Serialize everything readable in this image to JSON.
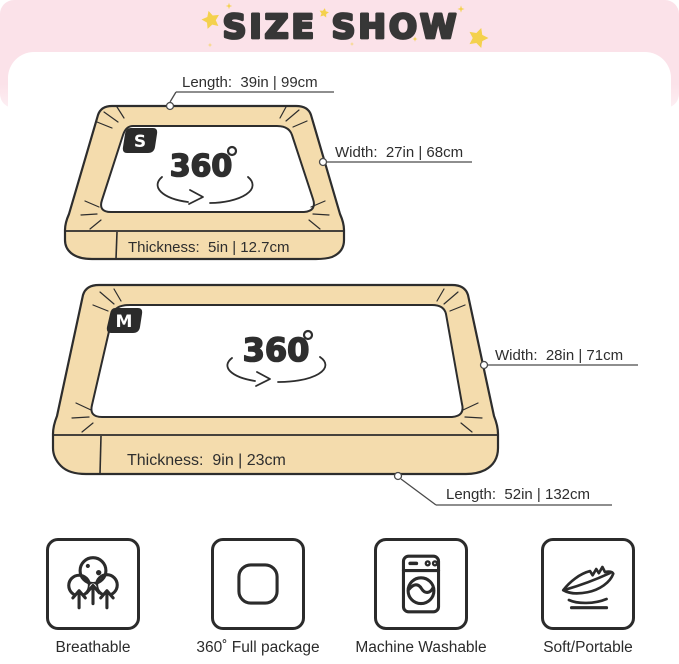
{
  "header": {
    "title": "SIZE SHOW"
  },
  "theme": {
    "pink": "#FBE2E9",
    "star_yellow": "#F4D14D",
    "bed_fill": "#F4DCAD",
    "outline": "#2D2D2D",
    "text": "#2E2E2E"
  },
  "beds": {
    "small": {
      "badge": "S",
      "rotation": "360",
      "length": "Length:  39in | 99cm",
      "width": "Width:  27in | 68cm",
      "thickness": "Thickness:  5in | 12.7cm"
    },
    "medium": {
      "badge": "M",
      "rotation": "360",
      "width": "Width:  28in | 71cm",
      "thickness": "Thickness:  9in | 23cm",
      "length": "Length:  52in | 132cm"
    }
  },
  "features": [
    {
      "label": "Breathable",
      "icon": "breathable-icon"
    },
    {
      "label": "360˚ Full package",
      "icon": "full-package-icon"
    },
    {
      "label": "Machine Washable",
      "icon": "machine-washable-icon"
    },
    {
      "label": "Soft/Portable",
      "icon": "feather-icon"
    }
  ]
}
